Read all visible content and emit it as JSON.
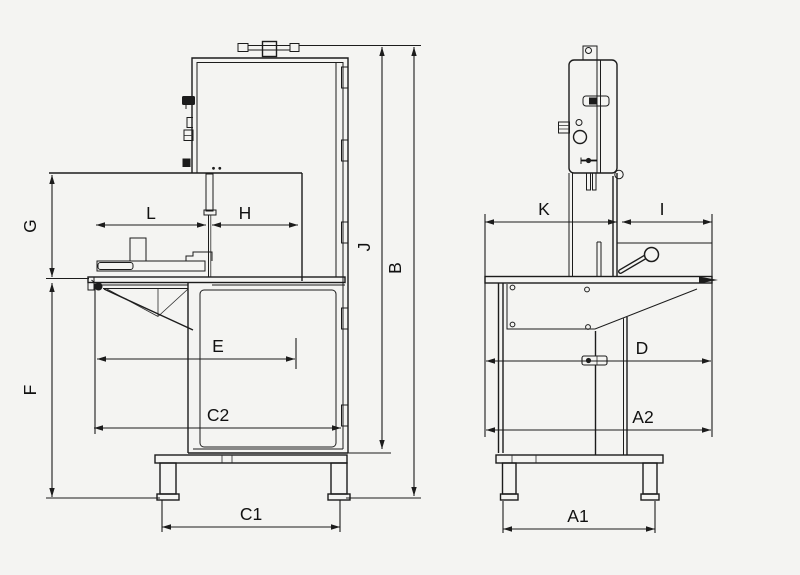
{
  "canvas": {
    "width": 800,
    "height": 575,
    "background": "#f4f4f2",
    "line_color": "#1c1c1c",
    "label_color": "#111111",
    "label_font_size": 17.5
  },
  "drawing": {
    "kind": "dimensional line drawing",
    "views": [
      "front-elevation",
      "side-elevation"
    ]
  },
  "dimensions": [
    {
      "id": "G",
      "axis": "v",
      "pos": 52,
      "from": 175,
      "to": 277,
      "label": "G",
      "label_x": 36,
      "label_y": 226,
      "rotated": true
    },
    {
      "id": "F",
      "axis": "v",
      "pos": 52,
      "from": 283,
      "to": 497,
      "label": "F",
      "label_x": 36,
      "label_y": 390,
      "rotated": true
    },
    {
      "id": "J",
      "axis": "v",
      "pos": 382,
      "from": 47,
      "to": 449,
      "label": "J",
      "label_x": 370,
      "label_y": 247,
      "rotated": true
    },
    {
      "id": "B",
      "axis": "v",
      "pos": 414,
      "from": 47,
      "to": 496,
      "label": "B",
      "label_x": 401,
      "label_y": 268,
      "rotated": true
    },
    {
      "id": "L",
      "axis": "h",
      "pos": 225,
      "from": 96,
      "to": 206,
      "label": "L",
      "label_x": 151,
      "label_y": 219
    },
    {
      "id": "H",
      "axis": "h",
      "pos": 225,
      "from": 212,
      "to": 298,
      "label": "H",
      "label_x": 245,
      "label_y": 219
    },
    {
      "id": "E",
      "axis": "h",
      "pos": 359,
      "from": 97,
      "to": 295,
      "label": "E",
      "label_x": 218,
      "label_y": 352
    },
    {
      "id": "C2",
      "axis": "h",
      "pos": 428,
      "from": 94,
      "to": 341,
      "label": "C2",
      "label_x": 218,
      "label_y": 421
    },
    {
      "id": "C1",
      "axis": "h",
      "pos": 527,
      "from": 162,
      "to": 340,
      "label": "C1",
      "label_x": 251,
      "label_y": 520
    },
    {
      "id": "K",
      "axis": "h",
      "pos": 222,
      "from": 485,
      "to": 617,
      "label": "K",
      "label_x": 544,
      "label_y": 215
    },
    {
      "id": "I",
      "axis": "h",
      "pos": 222,
      "from": 622,
      "to": 712,
      "label": "I",
      "label_x": 662,
      "label_y": 215
    },
    {
      "id": "D",
      "axis": "h",
      "pos": 361,
      "from": 486,
      "to": 711,
      "label": "D",
      "label_x": 642,
      "label_y": 354
    },
    {
      "id": "A2",
      "axis": "h",
      "pos": 430,
      "from": 486,
      "to": 711,
      "label": "A2",
      "label_x": 643,
      "label_y": 423
    },
    {
      "id": "A1",
      "axis": "h",
      "pos": 529,
      "from": 503,
      "to": 655,
      "label": "A1",
      "label_x": 578,
      "label_y": 522
    }
  ],
  "extension_lines": [
    {
      "axis": "h",
      "pos": 45.5,
      "from": 299,
      "to": 421
    },
    {
      "axis": "h",
      "pos": 278.5,
      "from": 46,
      "to": 89
    },
    {
      "axis": "h",
      "pos": 498,
      "from": 46,
      "to": 160
    },
    {
      "axis": "h",
      "pos": 498,
      "from": 346,
      "to": 421
    },
    {
      "axis": "h",
      "pos": 453,
      "from": 348,
      "to": 391
    },
    {
      "axis": "v",
      "pos": 95,
      "from": 284,
      "to": 434
    },
    {
      "axis": "v",
      "pos": 296,
      "from": 338,
      "to": 369
    },
    {
      "axis": "v",
      "pos": 162,
      "from": 500,
      "to": 532
    },
    {
      "axis": "v",
      "pos": 340,
      "from": 500,
      "to": 532
    },
    {
      "axis": "v",
      "pos": 485,
      "from": 214,
      "to": 437
    },
    {
      "axis": "v",
      "pos": 712,
      "from": 214,
      "to": 437
    },
    {
      "axis": "v",
      "pos": 503,
      "from": 501,
      "to": 533
    },
    {
      "axis": "v",
      "pos": 655,
      "from": 501,
      "to": 533
    }
  ]
}
